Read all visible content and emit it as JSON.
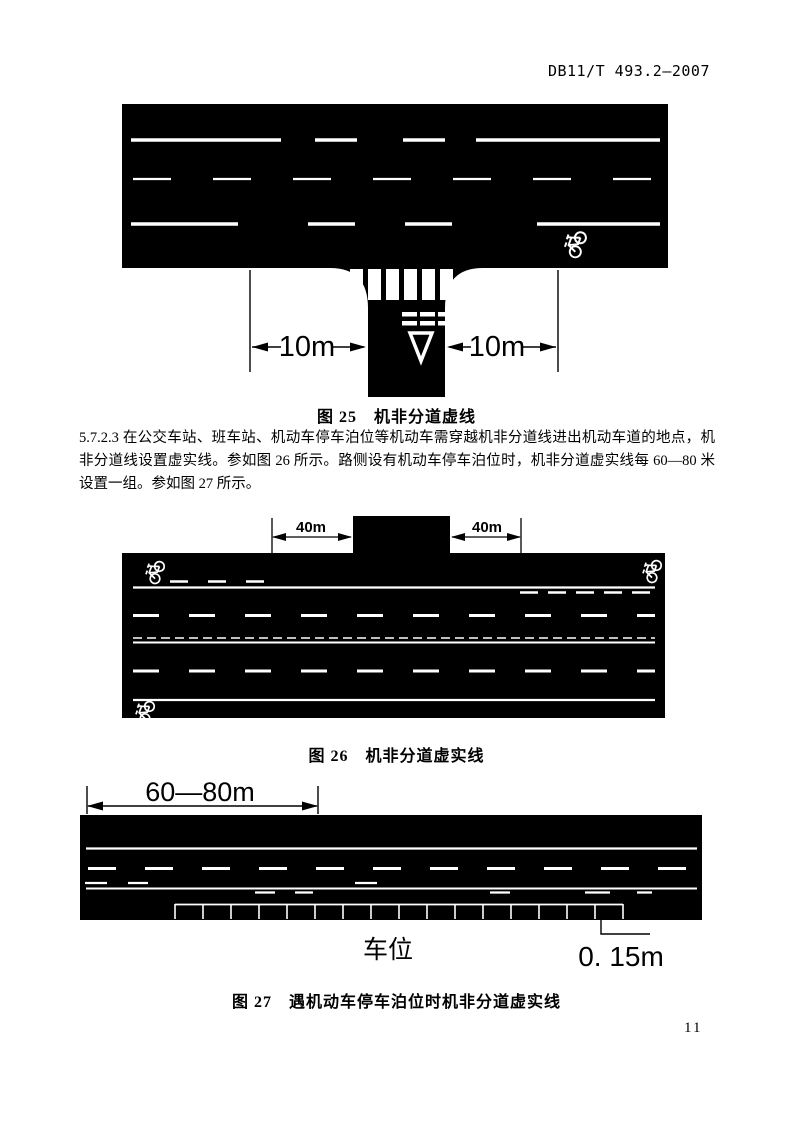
{
  "header": {
    "doc_number": "DB11/T 493.2—2007"
  },
  "paragraph": {
    "text": "5.7.2.3 在公交车站、班车站、机动车停车泊位等机动车需穿越机非分道线进出机动车道的地点，机非分道线设置虚实线。参如图 26 所示。路侧设有机动车停车泊位时，机非分道虚实线每 60—80 米设置一组。参如图 27 所示。"
  },
  "figure25": {
    "caption": "图 25　机非分道虚线",
    "dim_left": "10m",
    "dim_right": "10m"
  },
  "figure26": {
    "caption": "图 26　机非分道虚实线",
    "dim_left": "40m",
    "dim_right": "40m"
  },
  "figure27": {
    "caption": "图 27　遇机动车停车泊位时机非分道虚实线",
    "dim_span": "60—80m",
    "parking_label": "车位",
    "line_width_label": "0. 15m"
  },
  "page": {
    "number": "11"
  },
  "colors": {
    "road": "#000000",
    "marking": "#ffffff",
    "paper": "#ffffff",
    "ink": "#000000"
  }
}
